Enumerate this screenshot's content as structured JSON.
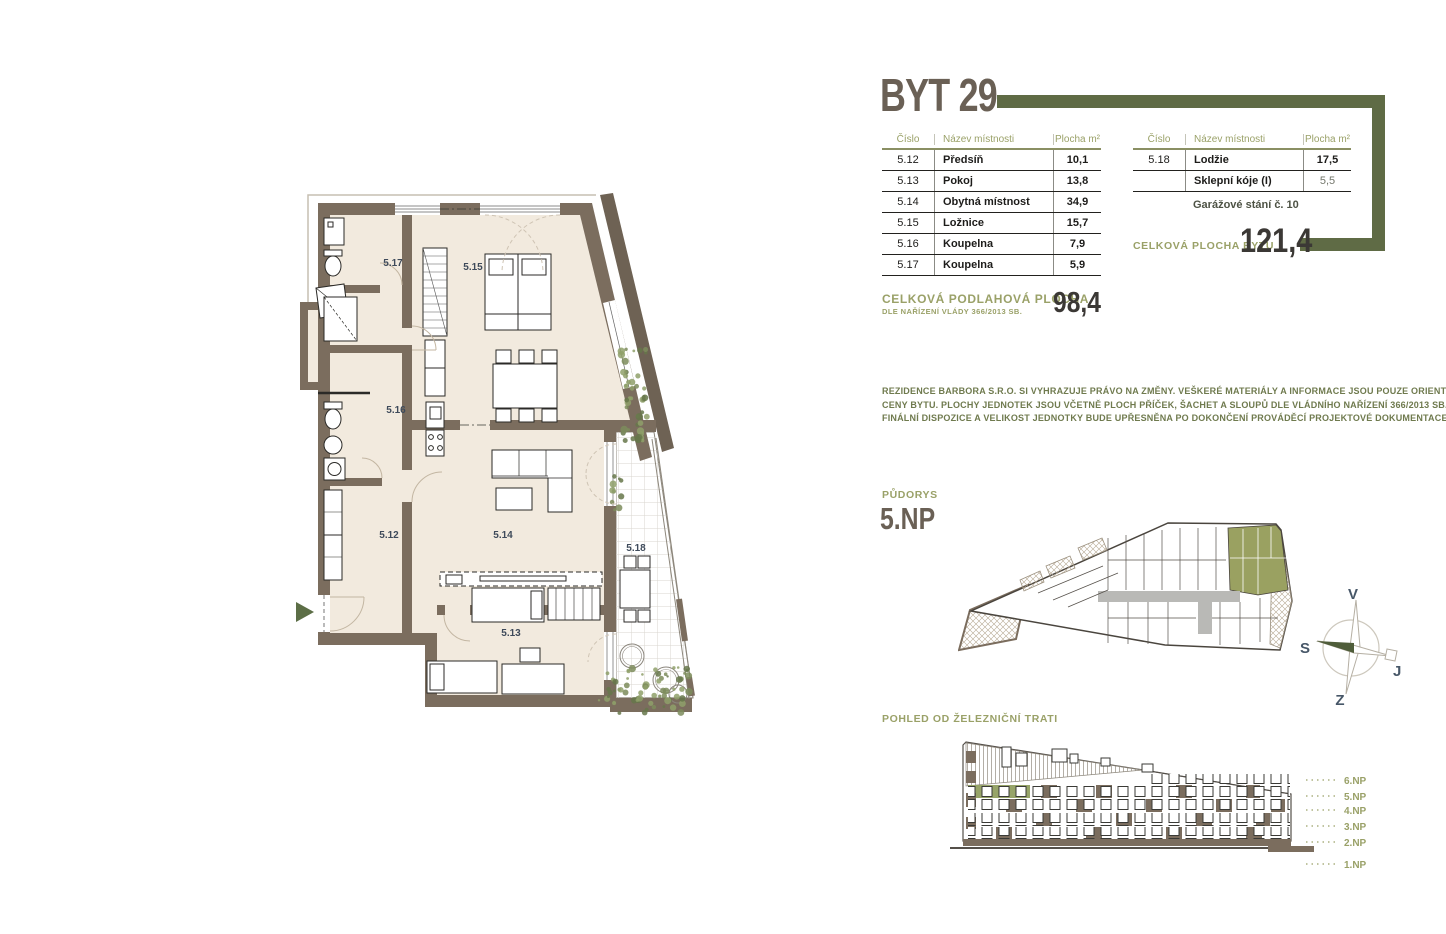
{
  "header": {
    "title": "BYT 29"
  },
  "tables": {
    "main": {
      "headers": [
        "Číslo",
        "Název místnosti",
        "Plocha m²"
      ],
      "rows": [
        [
          "5.12",
          "Předsíň",
          "10,1"
        ],
        [
          "5.13",
          "Pokoj",
          "13,8"
        ],
        [
          "5.14",
          "Obytná místnost",
          "34,9"
        ],
        [
          "5.15",
          "Ložnice",
          "15,7"
        ],
        [
          "5.16",
          "Koupelna",
          "7,9"
        ],
        [
          "5.17",
          "Koupelna",
          "5,9"
        ]
      ]
    },
    "extras": {
      "headers": [
        "Číslo",
        "Název místnosti",
        "Plocha m²"
      ],
      "rows": [
        [
          "5.18",
          "Lodžie",
          "17,5"
        ],
        [
          "",
          "Sklepní kóje (I)",
          "5,5"
        ]
      ],
      "note": "Garážové stání č. 10"
    }
  },
  "totals": {
    "apartment": {
      "label": "CELKOVÁ PLOCHA BYTU",
      "value": "121,4"
    },
    "floor": {
      "label": "CELKOVÁ PODLAHOVÁ  PLOCHA",
      "sublabel": "DLE NAŘÍZENÍ VLÁDY 366/2013 SB.",
      "value": "98,4"
    }
  },
  "disclaimer": {
    "line1": "REZIDENCE BARBORA S.R.O. SI VYHRAZUJE PRÁVO NA ZMĚNY. VEŠKERÉ MATERIÁLY A INFORMACE JSOU POUZE ORIENTAČNÍ. NÁBYTEK NENÍ SOUČÁSTÍ KUPNÍ",
    "line2": "CENY BYTU. PLOCHY JEDNOTEK JSOU VČETNĚ PLOCH PŘÍČEK, ŠACHET A SLOUPŮ DLE VLÁDNÍHO NAŘÍZENÍ 366/2013 SB.",
    "line3": "FINÁLNÍ DISPOZICE A VELIKOST JEDNOTKY BUDE UPŘESNĚNA PO DOKONČENÍ PROVÁDĚCÍ PROJEKTOVÉ DOKUMENTACE."
  },
  "floorplan": {
    "rooms": [
      "5.17",
      "5.15",
      "5.16",
      "5.12",
      "5.14",
      "5.13",
      "5.18"
    ]
  },
  "sitePlan": {
    "label": "PŮDORYS",
    "floor": "5.NP"
  },
  "compass": {
    "top": "V",
    "left": "S",
    "right": "J",
    "bottom": "Z"
  },
  "elevation": {
    "label": "POHLED OD ŽELEZNIČNÍ TRATI",
    "floors": [
      "6.NP",
      "5.NP",
      "4.NP",
      "3.NP",
      "2.NP",
      "1.NP"
    ]
  },
  "colors": {
    "accent_olive": "#5f6b45",
    "label_olive": "#9aa168",
    "wall_brown": "#7b6d5e",
    "floor_cream": "#f2eade",
    "unit_green": "#9aa161",
    "title_taupe": "#6a6055",
    "text_dark": "#1d1c1a"
  }
}
